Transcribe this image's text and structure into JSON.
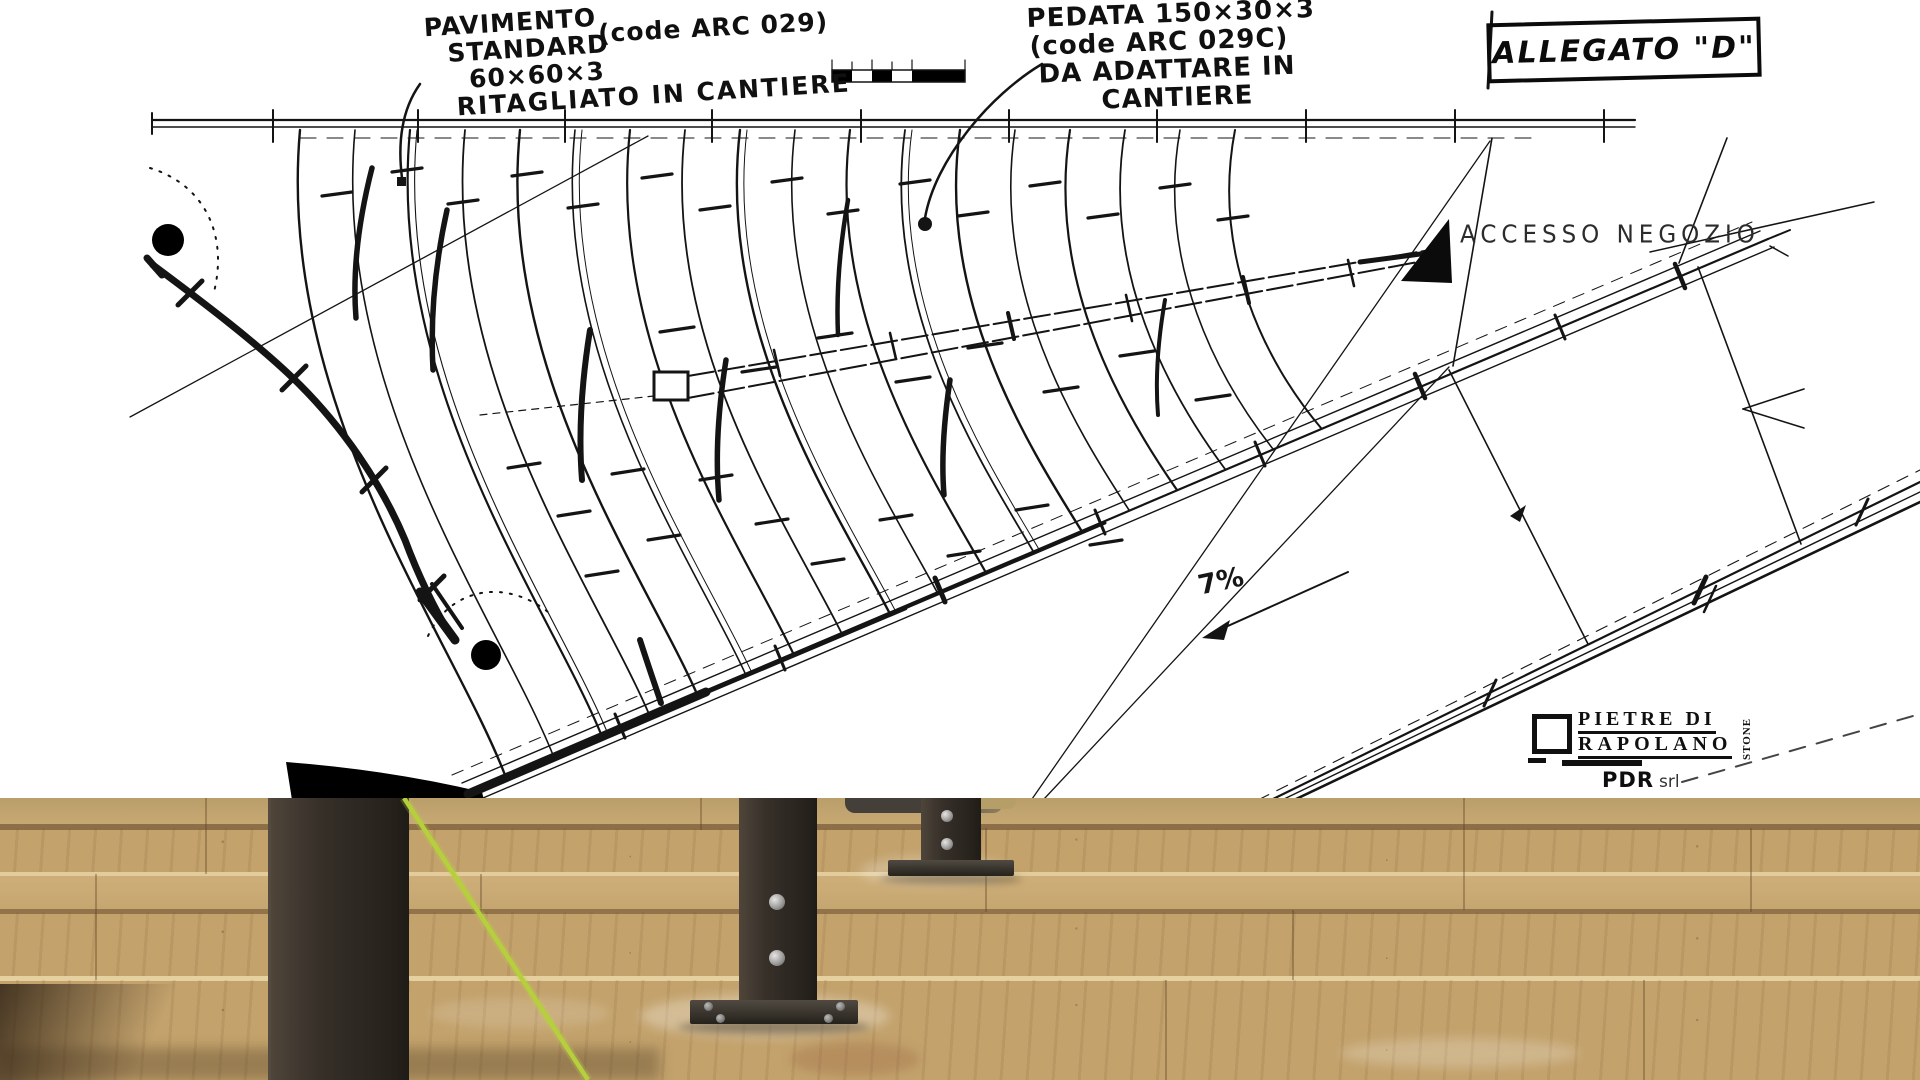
{
  "drawing": {
    "pavimento_note": {
      "line1": "PAVIMENTO",
      "line2": "STANDARD",
      "code": "(code ARC 029)",
      "line3": "60×60×3",
      "line4": "RITAGLIATO IN CANTIERE"
    },
    "pedata_note": {
      "line1": "PEDATA 150×30×3",
      "line2": "(code ARC 029C)",
      "line3": "DA ADATTARE IN",
      "line4": "CANTIERE"
    },
    "allegato_label": "ALLEGATO \"D\"",
    "accesso_label": "ACCESSO NEGOZIO",
    "slope_label": "7%"
  },
  "logo": {
    "line1": "PIETRE DI",
    "line2": "RAPOLANO",
    "vertical": "STONE",
    "company": "PDR",
    "company_suffix": "srl"
  },
  "colors": {
    "ink": "#141414",
    "paper": "#ffffff",
    "stone_tread": "#cdac74",
    "stone_riser": "#a87a47",
    "metal_post": "#2b2520",
    "string_green": "#b9d53c"
  }
}
